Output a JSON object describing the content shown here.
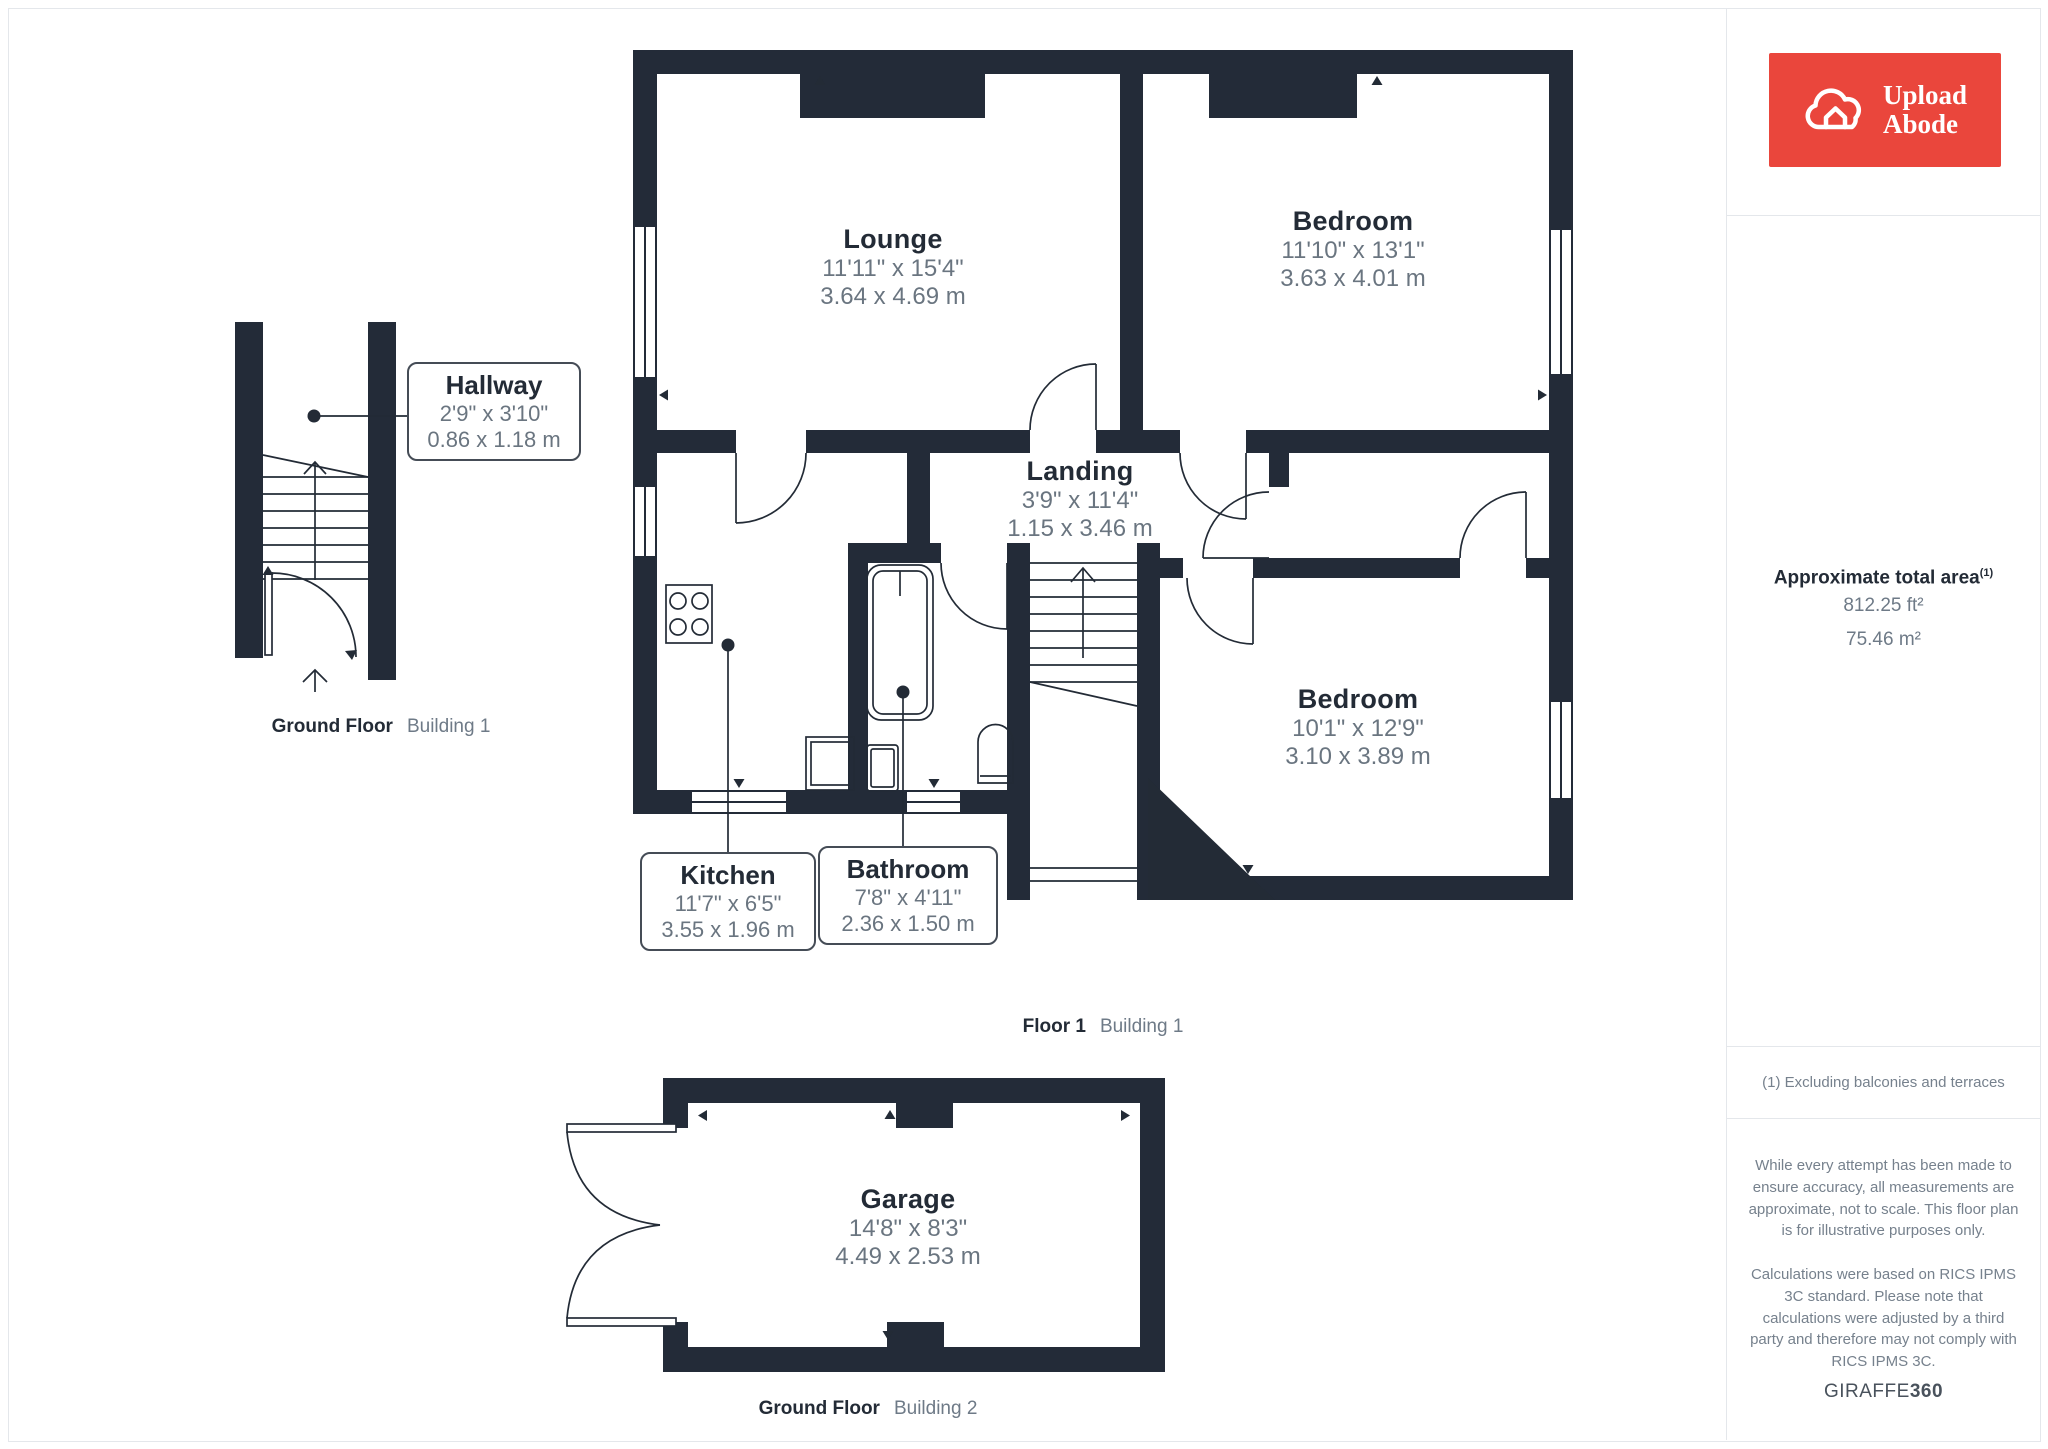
{
  "branding": {
    "logo_line1": "Upload",
    "logo_line2": "Abode"
  },
  "sidebar": {
    "area_title": "Approximate total area",
    "area_sup": "(1)",
    "area_ft": "812.25 ft²",
    "area_m": "75.46 m²",
    "note": "(1) Excluding balconies and terraces",
    "disclaimer1": "While every attempt has been made to ensure accuracy, all measurements are approximate, not to scale. This floor plan is for illustrative purposes only.",
    "disclaimer2": "Calculations were based on RICS IPMS 3C standard. Please note that calculations were adjusted by a third party and therefore may not comply with RICS IPMS 3C.",
    "watermark_regular": "GIRAFFE",
    "watermark_bold": "360"
  },
  "floors": {
    "ground1": {
      "label": "Ground Floor",
      "building": "Building 1"
    },
    "floor1": {
      "label": "Floor 1",
      "building": "Building 1"
    },
    "ground2": {
      "label": "Ground Floor",
      "building": "Building 2"
    }
  },
  "rooms": {
    "hallway": {
      "name": "Hallway",
      "imperial": "2'9\" x 3'10\"",
      "metric": "0.86 x 1.18 m"
    },
    "lounge": {
      "name": "Lounge",
      "imperial": "11'11\" x 15'4\"",
      "metric": "3.64 x 4.69 m"
    },
    "bedroom1": {
      "name": "Bedroom",
      "imperial": "11'10\" x 13'1\"",
      "metric": "3.63 x 4.01 m"
    },
    "landing": {
      "name": "Landing",
      "imperial": "3'9\" x 11'4\"",
      "metric": "1.15 x 3.46 m"
    },
    "kitchen": {
      "name": "Kitchen",
      "imperial": "11'7\" x 6'5\"",
      "metric": "3.55 x 1.96 m"
    },
    "bathroom": {
      "name": "Bathroom",
      "imperial": "7'8\" x 4'11\"",
      "metric": "2.36 x 1.50 m"
    },
    "bedroom2": {
      "name": "Bedroom",
      "imperial": "10'1\" x 12'9\"",
      "metric": "3.10 x 3.89 m"
    },
    "garage": {
      "name": "Garage",
      "imperial": "14'8\" x 8'3\"",
      "metric": "4.49 x 2.53 m"
    }
  },
  "colors": {
    "wall": "#232B38",
    "dim_text": "#6A7580",
    "logo_red": "#EA463C",
    "divider": "#E4E7EB"
  }
}
